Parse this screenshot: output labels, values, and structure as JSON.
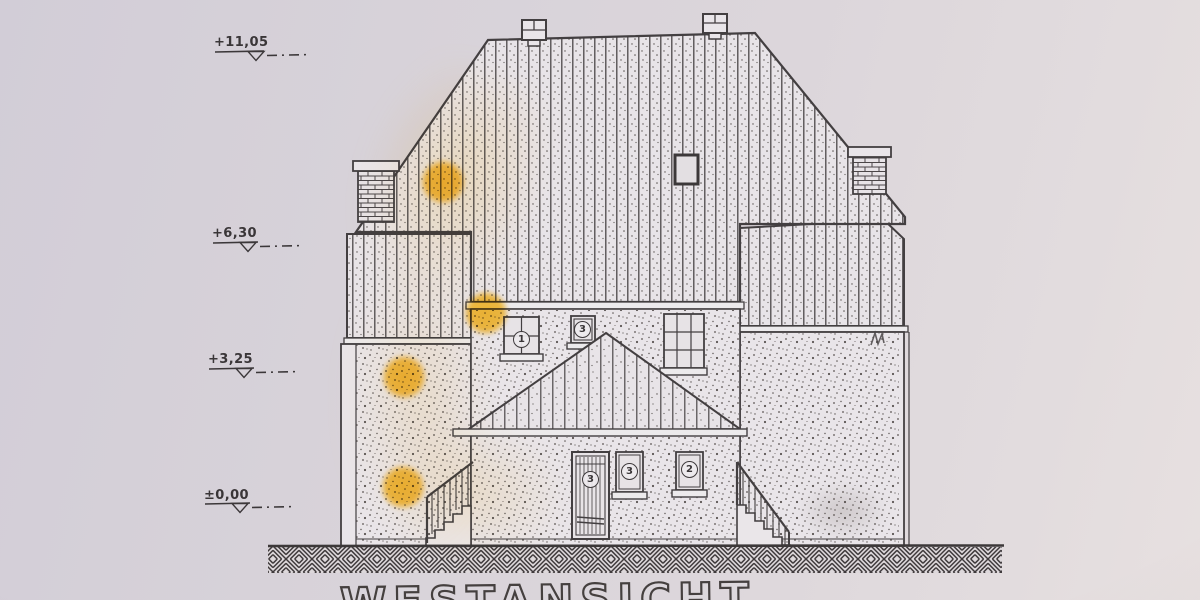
{
  "drawing": {
    "title": "WESTANSICHT"
  },
  "elevation_markers": [
    {
      "label": "+11,05"
    },
    {
      "label": "+6,30"
    },
    {
      "label": "+3,25"
    },
    {
      "label": "±0,00"
    }
  ],
  "opening_badges": {
    "upper_window_left": "1",
    "upper_window_small": "3",
    "door": "3",
    "ground_window_left": "3",
    "ground_window_right": "2"
  },
  "colors": {
    "paper": "#d8d3da",
    "ink": "#423e40",
    "wall_fill": "#e9e5e9",
    "highlighter": "#ffc22e"
  }
}
